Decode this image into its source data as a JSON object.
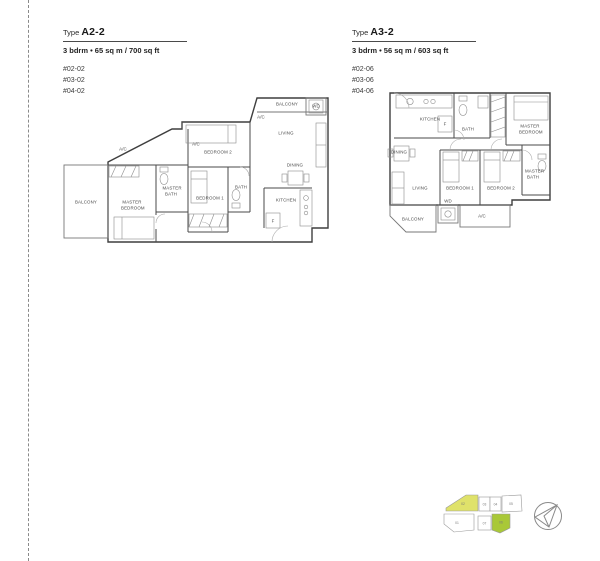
{
  "plans": [
    {
      "type_prefix": "Type",
      "type_name": "A2-2",
      "spec": "3 bdrm • 65 sq m / 700 sq ft",
      "units": [
        "#02-02",
        "#03-02",
        "#04-02"
      ],
      "rooms": {
        "balcony": "BALCONY",
        "balcony_top": "BALCONY",
        "master_bedroom": "MASTER BEDROOM",
        "master_bath": "MASTER BATH",
        "bedroom1": "BEDROOM 1",
        "bedroom2": "BEDROOM 2",
        "bath": "BATH",
        "kitchen": "KITCHEN",
        "living": "LIVING",
        "dining": "DINING",
        "wd": "WD",
        "ac": "A/C",
        "fridge": "F"
      }
    },
    {
      "type_prefix": "Type",
      "type_name": "A3-2",
      "spec": "3 bdrm • 56 sq m / 603 sq ft",
      "units": [
        "#02-06",
        "#03-06",
        "#04-06"
      ],
      "rooms": {
        "kitchen": "KITCHEN",
        "fridge": "F",
        "bath": "BATH",
        "master_bedroom": "MASTER BEDROOM",
        "master_bath": "MASTER BATH",
        "dining": "DINING",
        "living": "LIVING",
        "bedroom1": "BEDROOM 1",
        "bedroom2": "BEDROOM 2",
        "balcony": "BALCONY",
        "wd": "WD",
        "ac": "A/C"
      }
    }
  ],
  "keyplan": {
    "unit_numbers": [
      "01",
      "02",
      "03",
      "04",
      "05",
      "06",
      "07"
    ],
    "colors": {
      "yellow": "#dfe26a",
      "green": "#a9c838"
    }
  },
  "icons": {
    "compass": "compass-north"
  }
}
